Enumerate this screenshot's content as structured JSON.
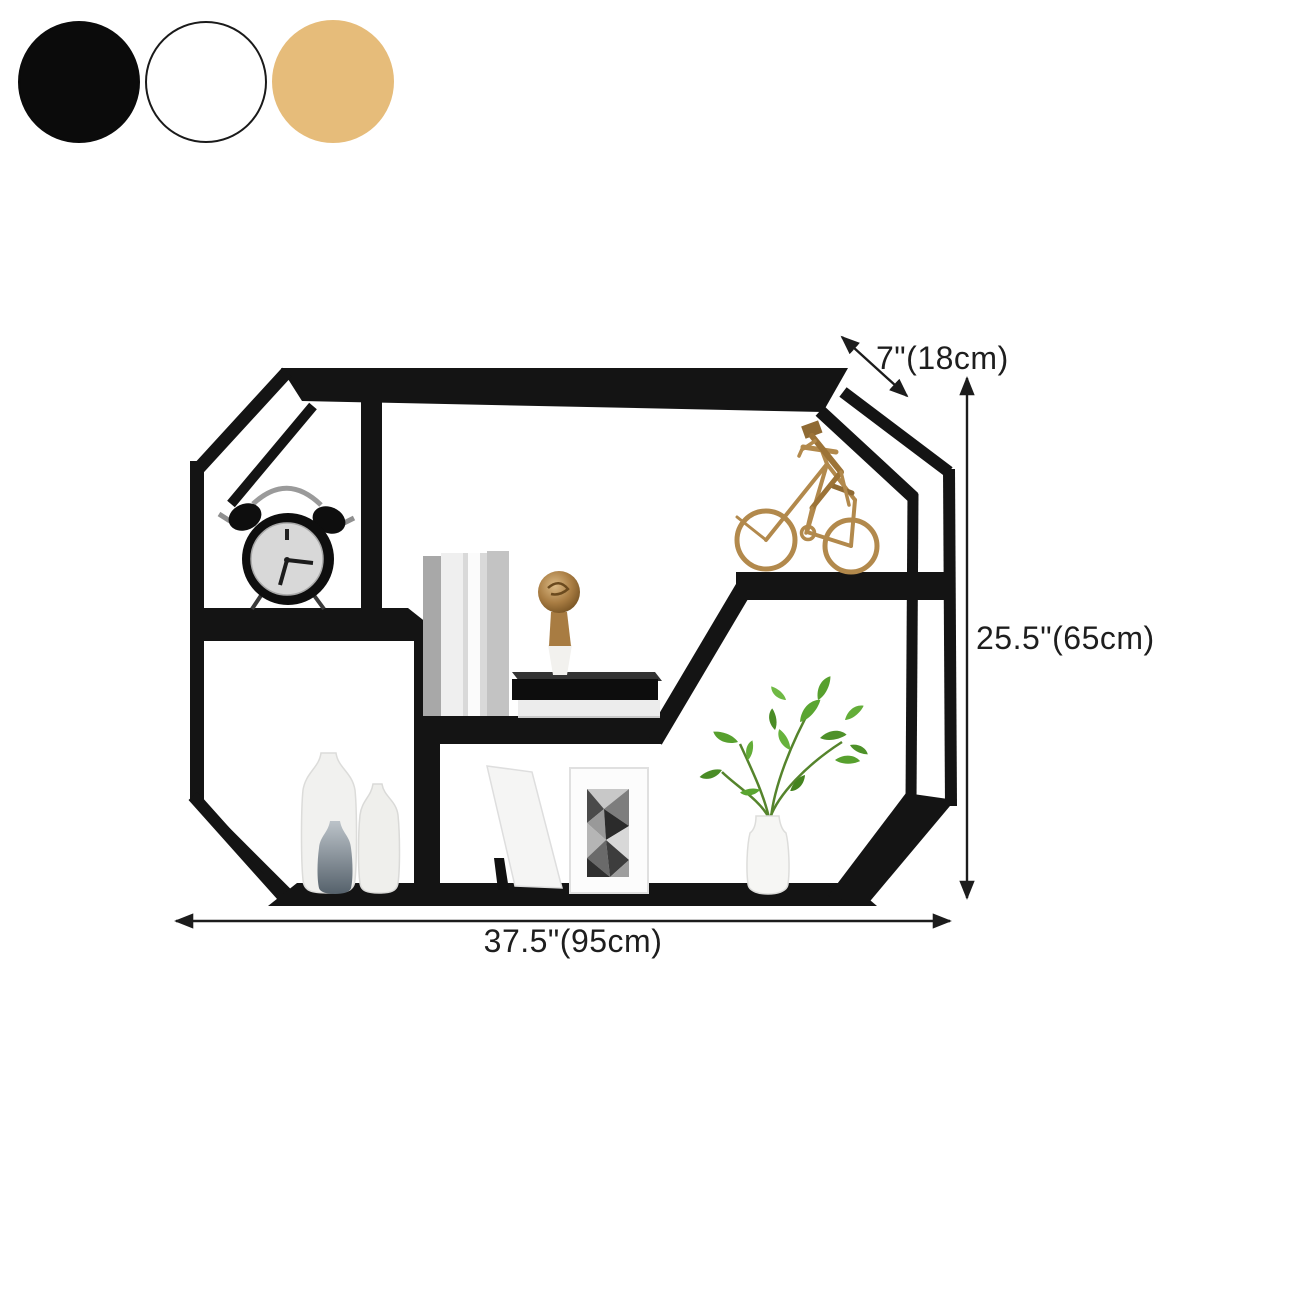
{
  "page": {
    "background": "#ffffff"
  },
  "swatches": {
    "items": [
      {
        "name": "black",
        "color": "#0b0b0b",
        "border": "#0b0b0b"
      },
      {
        "name": "white",
        "color": "#ffffff",
        "border": "#1a1a1a"
      },
      {
        "name": "gold",
        "color": "#e6bc7a",
        "border": "#e6bc7a"
      }
    ]
  },
  "dimensions": {
    "depth": "7\"(18cm)",
    "height": "25.5\"(65cm)",
    "width": "37.5\"(95cm)"
  },
  "product": {
    "type": "octagonal wall-mounted shelf",
    "frame_color": "#141414",
    "accent_gold": "#b2894c",
    "plant_green": "#57a02e",
    "decor": [
      "alarm-clock",
      "books",
      "gold-finial",
      "bicycle-figurine",
      "white-vases",
      "photo-frames",
      "potted-plant"
    ]
  }
}
